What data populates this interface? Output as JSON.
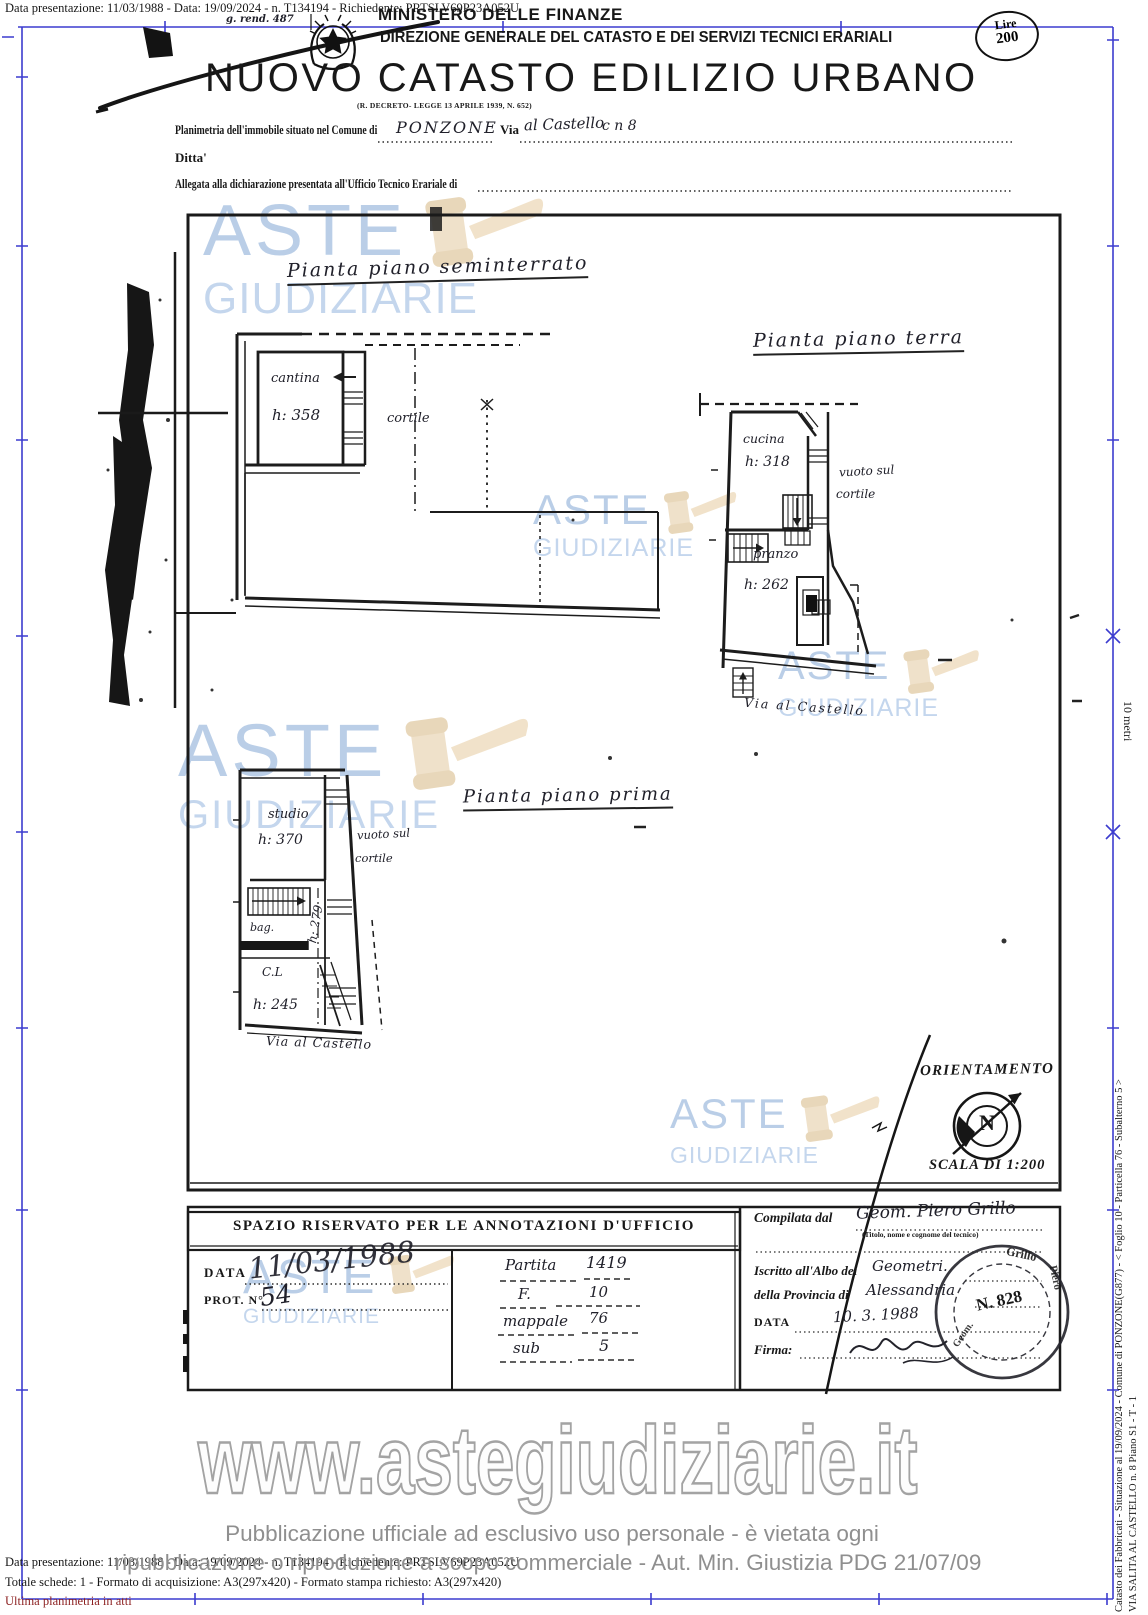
{
  "colors": {
    "frame_blue": "#3c3ccf",
    "watermark_blue": "#a9c3e2",
    "gavel_tan": "#ecdabd",
    "ink_black": "#1a1a1a",
    "notice_gray": "#8f8f8f",
    "link_maroon": "#8b1f1f"
  },
  "header": {
    "dataline": "Data presentazione: 11/03/1988 - Data: 19/09/2024 - n. T134194 - Richiedente: PRTSLV69P23A052U",
    "note": "g. rend.  487",
    "ministry": "MINISTERO DELLE FINANZE",
    "direction": "DIREZIONE GENERALE DEL CATASTO E DEI SERVIZI TECNICI ERARIALI",
    "title": "NUOVO CATASTO EDILIZIO URBANO",
    "decree": "(R. DECRETO- LEGGE 13 APRILE 1939, N. 652)",
    "stamp": {
      "line1": "Lire",
      "line2": "200"
    }
  },
  "form": {
    "planimetria_label": "Planimetria dell'immobile situato nel Comune di",
    "comune": "PONZONE",
    "via_label": "Via",
    "via": "al Castello",
    "civico": "c n 8",
    "ditta_label": "Ditta'",
    "allegata_label": "Allegata alla dichiarazione presentata all'Ufficio Tecnico Erariale di"
  },
  "plans": {
    "seminterrato": {
      "title": "Pianta piano seminterrato",
      "rooms": [
        {
          "name": "cantina",
          "height": "h: 358"
        }
      ],
      "cortile": "cortile"
    },
    "terra": {
      "title": "Pianta piano terra",
      "rooms": [
        {
          "name": "cucina",
          "height": "h: 318"
        },
        {
          "name": "pranzo",
          "height": "h: 262"
        }
      ],
      "vuoto1": "vuoto sul",
      "vuoto2": "cortile",
      "via": "Via al Castello"
    },
    "primo": {
      "title": "Pianta piano prima",
      "rooms": [
        {
          "name": "studio",
          "height": "h: 370"
        },
        {
          "name": "bag.",
          "height": ""
        },
        {
          "name": "C.L",
          "height": "h: 245"
        }
      ],
      "vuoto1": "vuoto sul",
      "vuoto2": "cortile",
      "h_scala": "h: 279",
      "via": "Via al Castello"
    }
  },
  "orientation": {
    "label": "ORIENTAMENTO",
    "north": "N",
    "scala": "SCALA DI 1:200"
  },
  "annotations": {
    "header": "SPAZIO RISERVATO PER LE ANNOTAZIONI D'UFFICIO",
    "data_label": "DATA",
    "data_value": "11/03/1988",
    "prot_label": "PROT. N°",
    "prot_value": "54",
    "rows": [
      {
        "label": "Partita",
        "value": "1419"
      },
      {
        "label": "F.",
        "value": "10"
      },
      {
        "label": "mappale",
        "value": "76"
      },
      {
        "label": "sub",
        "value": "5"
      }
    ]
  },
  "compilata": {
    "label": "Compilata dal",
    "tecnico": "Geom. Piero Grillo",
    "subscript": "(Titolo, nome e cognome del tecnico)",
    "iscritto_label": "Iscritto all'Albo dei",
    "albo_value": "Geometri.",
    "provincia_label": "della Provincia di",
    "provincia_value": "Alessandria",
    "data_label": "DATA",
    "data_value": "10. 3. 1988",
    "firma_label": "Firma:",
    "stamp": {
      "n": "N. 828",
      "name1": "Grillo",
      "name2": "Piero",
      "title": "Geom."
    }
  },
  "watermark": {
    "word1": "ASTE",
    "word2": "GIUDIZIARIE",
    "url": "www.astegiudiziarie.it"
  },
  "sidebar": {
    "line1": "Catasto dei Fabbricati - Situazione al 19/09/2024 - Comune di PONZONE(G877) - < Foglio 10 - Particella 76 - Subalterno 5 >",
    "line2": "VIA SALITA AL CASTELLO n. 8 Piano S1 - T - 1",
    "scale_label": "10 metri"
  },
  "footer": {
    "notice1": "Pubblicazione ufficiale ad esclusivo uso personale - è vietata ogni",
    "notice2": "ripubblicazione o riproduzione a scopo commerciale - Aut. Min. Giustizia PDG 21/07/09",
    "dataline": "Data presentazione: 11/03/1988 - Data: 19/09/2024 - n. T134194 - Richiedente: PRTSLV69P23A052U",
    "totale": "Totale schede: 1 - Formato di acquisizione: A3(297x420)  - Formato stampa richiesto: A3(297x420)",
    "ultima": "Ultima planimetria in atti"
  }
}
